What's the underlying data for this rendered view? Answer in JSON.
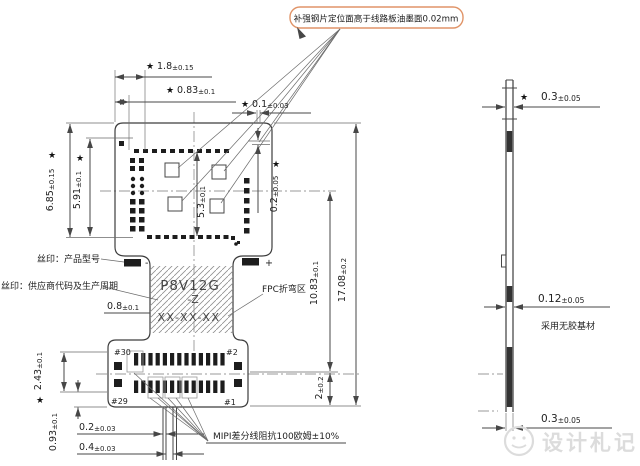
{
  "note": {
    "text": "补强钢片定位面高于线路板油墨面0.02mm"
  },
  "glyphs": {
    "star": "★",
    "plus": "+",
    "minus": "-"
  },
  "dims": {
    "top_18": {
      "v": "1.8",
      "t": "±0.15"
    },
    "top_083": {
      "v": "0.83",
      "t": "±0.1"
    },
    "top_01": {
      "v": "0.1",
      "t": "±0.03"
    },
    "left_685": {
      "v": "6.85",
      "t": "±0.15"
    },
    "left_591": {
      "v": "5.91",
      "t": "±0.1"
    },
    "mid_53": {
      "v": "5.3",
      "t": "±0.1"
    },
    "right_02": {
      "v": "0.2",
      "t": "±0.05"
    },
    "neck_08": {
      "v": "0.8",
      "t": "±0.1"
    },
    "right_1083": {
      "v": "10.83",
      "t": "±0.1"
    },
    "right_1708": {
      "v": "17.08",
      "t": "±0.2"
    },
    "bot_2": {
      "v": "2",
      "t": "±0.2"
    },
    "bl_243": {
      "v": "2.43",
      "t": "±0.1"
    },
    "bl_093": {
      "v": "0.93",
      "t": "±0.1"
    },
    "bl_02": {
      "v": "0.2",
      "t": "±0.03"
    },
    "bl_04": {
      "v": "0.4",
      "t": "±0.03"
    },
    "side_top": {
      "v": "0.3",
      "t": "±0.05"
    },
    "side_mid": {
      "v": "0.12",
      "t": "±0.05"
    },
    "side_bot": {
      "v": "0.3",
      "t": "±0.05"
    }
  },
  "labels": {
    "silk_model": "丝印：产品型号",
    "silk_vendor": "丝印：供应商代码及生产周期",
    "fpc_bend_zone": "FPC折弯区",
    "mipi_impedance": "MIPI差分线阻抗100欧姆±10%",
    "no_glue_base": "采用无胶基材",
    "model_line1": "P8V12G",
    "model_line2": "-Z",
    "model_line3": "XX-XX-XX",
    "pin_30": "#30",
    "pin_2": "#2",
    "pin_29": "#29",
    "pin_1": "#1"
  },
  "watermark": {
    "text": "设计札记"
  },
  "colors": {
    "note_border": "#e09468",
    "line": "#474747",
    "watermark": "#dcdcdc"
  }
}
